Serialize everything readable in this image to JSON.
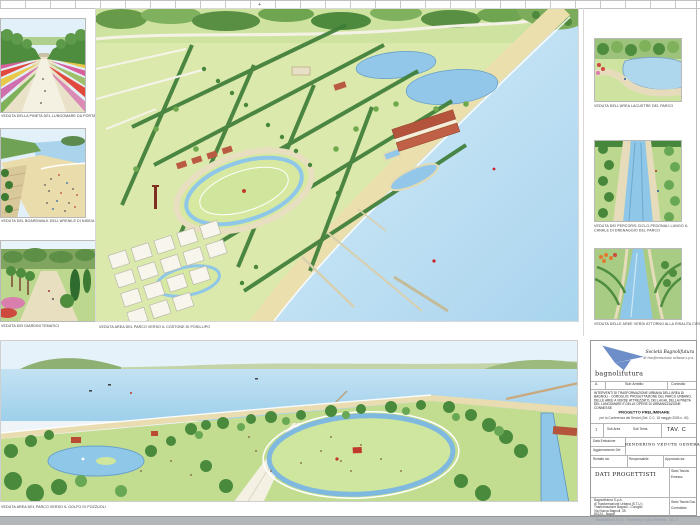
{
  "sheet": {
    "palette": {
      "sea": "#a9d4ec",
      "sand": "#ecdfae",
      "lawn": "#cfe3a0",
      "tree_dark": "#47873c",
      "tree_light": "#7fb15a",
      "roof_red": "#b5543c",
      "water_light": "#8ec7e8",
      "logo_blue": "#6d8ec9"
    }
  },
  "panels": {
    "left": [
      {
        "caption": "VEDUTA DELLA PINETA DEL LUNGOMARE DA PORTA NISIDA"
      },
      {
        "caption": "VEDUTA DEL BOARDWALK DELL'ARENILE DI NISIDA"
      },
      {
        "caption": "VEDUTA DEI GIARDINI TEMATICI"
      }
    ],
    "center": {
      "caption": "VEDUTA AREA DEL PARCO VERSO IL COSTONE DI POSILLIPO"
    },
    "right": [
      {
        "caption": "VEDUTA DELL'AREA LACUSTRE DEL PARCO"
      },
      {
        "caption": "VEDUTA DEI PERCORSI CICLO-PEDONALI LUNGO IL CANALE DI DRENAGGIO DEL PARCO"
      },
      {
        "caption": "VEDUTA DELLE AREE VERDI ATTORNO ALLA RISALITA CIRCOLARE"
      }
    ],
    "bottom": {
      "caption": "VEDUTA AREA DEL PARCO VERSO IL GOLFO DI POZZUOLI"
    }
  },
  "title_block": {
    "company": "Società Bagnolifutura",
    "company_sub": "di trasformazione urbana s.p.a.",
    "wordmark": "bagnolifutura",
    "header_row": {
      "c1": "A",
      "c2": "Sub Ambito",
      "c3": "Controllo"
    },
    "description": "INTERVENTI DI TRASFORMAZIONE URBANA DELL'AREA DI BAGNOLI - COROGLIO: PROGETTAZIONE DEL PARCO URBANO, DELLE AREE A VERDE ATTREZZATO, DEI LAGHI, DELLA PINETA DEL LUNGOMARE E DELLE OPERE DI URBANIZZAZIONE CONNESSE",
    "phase": "PROGETTO PRELIMINARE",
    "phase_sub": "per la Conferenza dei Servizi (Del. C.C. 18 maggio 2005 n. 40)",
    "sheet_row": {
      "num": "1",
      "sub_area": "Sub Area",
      "sub_tema": "Sub Tema",
      "tav": "TAV. C"
    },
    "emission_label": "Data Emissione",
    "update_label": "Aggiornamento Del",
    "drawing_title": "RENDERING VEDUTE GENERALI",
    "sign_cols": [
      {
        "label": "Redatto da:"
      },
      {
        "label": "Responsabile:"
      },
      {
        "label": "Approvato da:"
      }
    ],
    "designers_label": "DATI PROGETTISTI",
    "state_label": "Stato Tavola:",
    "state_value": "Emesso",
    "address_lines": [
      "Bagnolifutura S.p.A.",
      "di Trasformazione Urbana (S.T.U.)",
      "Trasformazione Bagnoli - Coroglio",
      "Via Nuova Bagnoli, 35",
      "80124 - Napoli"
    ],
    "doc_state_l1": "Stato Tavola Doc.",
    "doc_state_l2": "Controllato",
    "footer_note": "Bagnolifutura S.p.A. - Rendering Vedute Generali - TAV. C"
  }
}
